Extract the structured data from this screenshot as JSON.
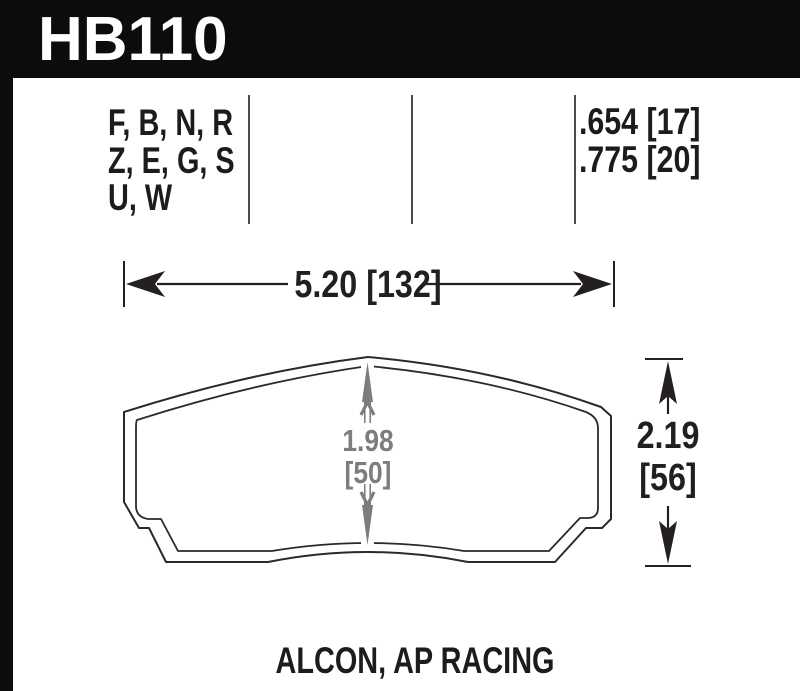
{
  "header": {
    "part_number": "HB110"
  },
  "spec_columns": {
    "compound_codes": [
      "F, B, N, R",
      "Z, E, G, S",
      "U, W"
    ],
    "pad_thickness": [
      ".654 [17]",
      ".775 [20]"
    ]
  },
  "dimensions": {
    "overall_width": {
      "label": "5.20 [132]"
    },
    "overall_height": {
      "inches": "2.19",
      "millimeters": "[56]"
    },
    "pad_center_height": {
      "inches": "1.98",
      "millimeters": "[50]"
    }
  },
  "footer": {
    "applications": "ALCON, AP RACING"
  },
  "colors": {
    "header_bg": "#0c0c0c",
    "drawing_line": "#2b2a29",
    "dimension_gray": "#7d7d7d"
  }
}
